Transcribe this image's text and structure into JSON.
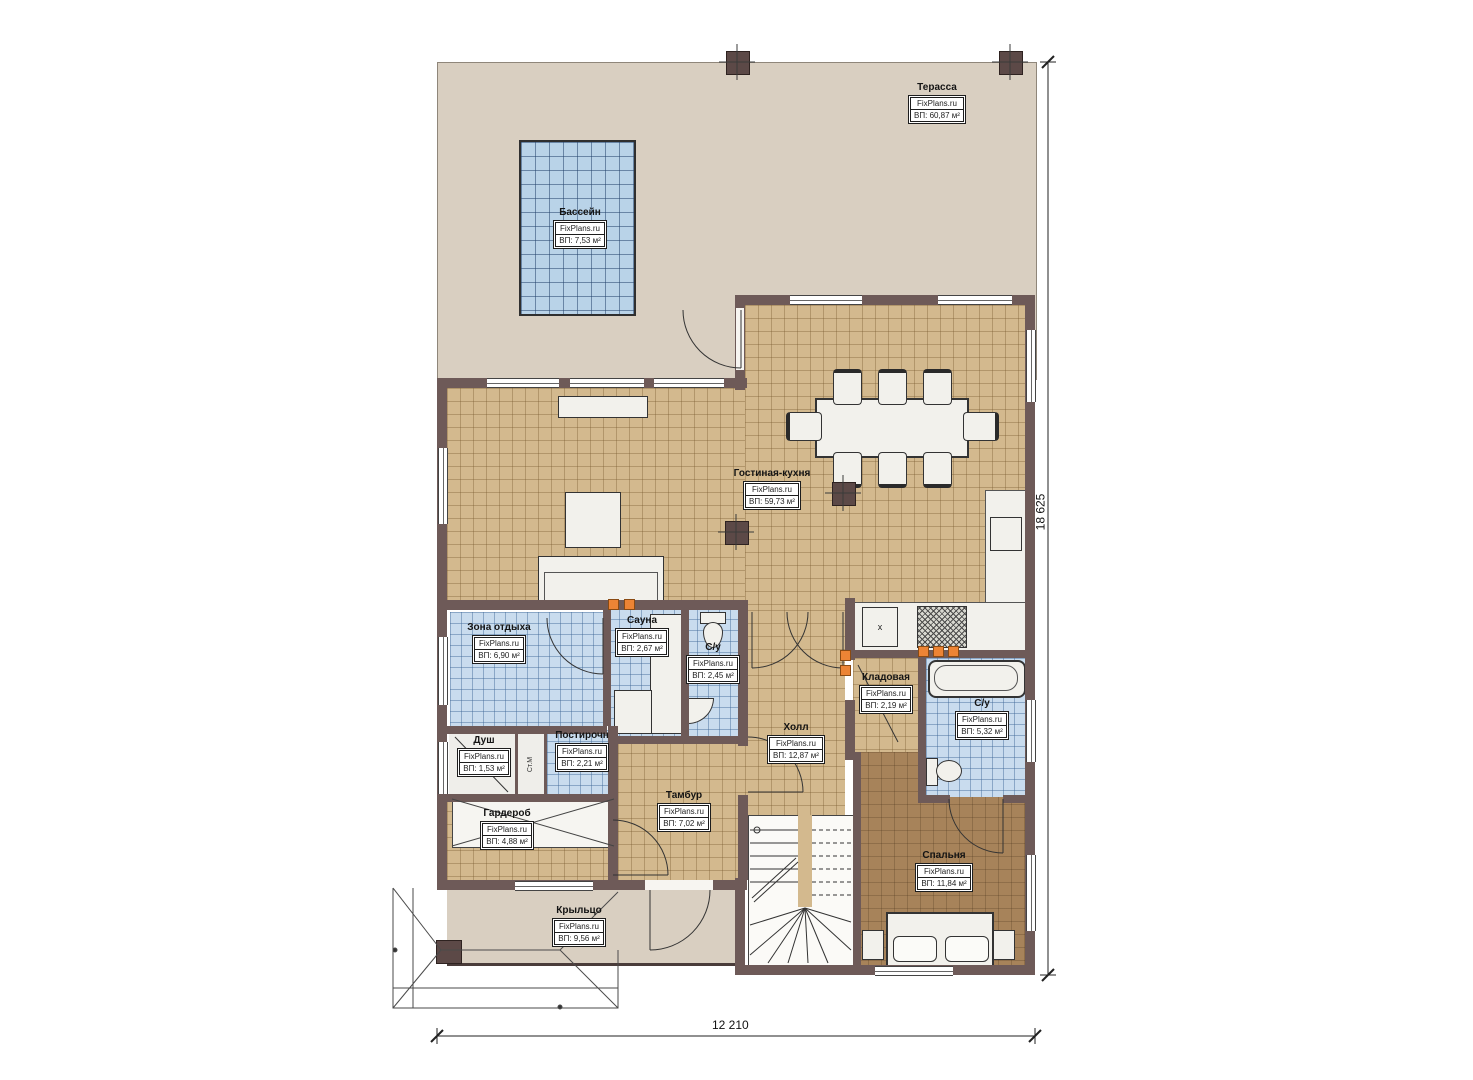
{
  "plan_title": "План 1 этажа",
  "rooms": {
    "terrace": {
      "name": "Терасса",
      "brand": "FixPlans.ru",
      "area": "ВП: 60,87 м²"
    },
    "pool": {
      "name": "Бассейн",
      "brand": "FixPlans.ru",
      "area": "ВП: 7,53 м²"
    },
    "living": {
      "name": "Гостиная-кухня",
      "brand": "FixPlans.ru",
      "area": "ВП: 59,73 м²"
    },
    "rest": {
      "name": "Зона отдыха",
      "brand": "FixPlans.ru",
      "area": "ВП: 6,90 м²"
    },
    "sauna": {
      "name": "Сауна",
      "brand": "FixPlans.ru",
      "area": "ВП: 2,67 м²"
    },
    "wc1": {
      "name": "С/у",
      "brand": "FixPlans.ru",
      "area": "ВП: 2,45 м²"
    },
    "hall": {
      "name": "Холл",
      "brand": "FixPlans.ru",
      "area": "ВП: 12,87 м²"
    },
    "storage": {
      "name": "Кладовая",
      "brand": "FixPlans.ru",
      "area": "ВП: 2,19 м²"
    },
    "wc2": {
      "name": "С/у",
      "brand": "FixPlans.ru",
      "area": "ВП: 5,32 м²"
    },
    "shower": {
      "name": "Душ",
      "brand": "FixPlans.ru",
      "area": "ВП: 1,53 м²"
    },
    "laundry": {
      "name": "Постирочн",
      "brand": "FixPlans.ru",
      "area": "ВП: 2,21 м²"
    },
    "wardrobe": {
      "name": "Гардероб",
      "brand": "FixPlans.ru",
      "area": "ВП: 4,88 м²"
    },
    "vestibule": {
      "name": "Тамбур",
      "brand": "FixPlans.ru",
      "area": "ВП: 7,02 м²"
    },
    "bedroom": {
      "name": "Спальня",
      "brand": "FixPlans.ru",
      "area": "ВП: 11,84 м²"
    },
    "porch": {
      "name": "Крыльцо",
      "brand": "FixPlans.ru",
      "area": "ВП: 9,56 м²"
    }
  },
  "markers": {
    "kitchen_sink": "х",
    "washing_machine": "Ст.М"
  },
  "dimensions": {
    "width_mm": "12 210",
    "height_mm": "18 625"
  },
  "colors": {
    "wall": "#6e5a58",
    "floor_tan": "#d3b98e",
    "floor_tile_blue": "#c9dcee",
    "floor_bedroom": "#a7835a",
    "terrace": "#d9cfc1",
    "accent_orange": "#ec8435"
  }
}
